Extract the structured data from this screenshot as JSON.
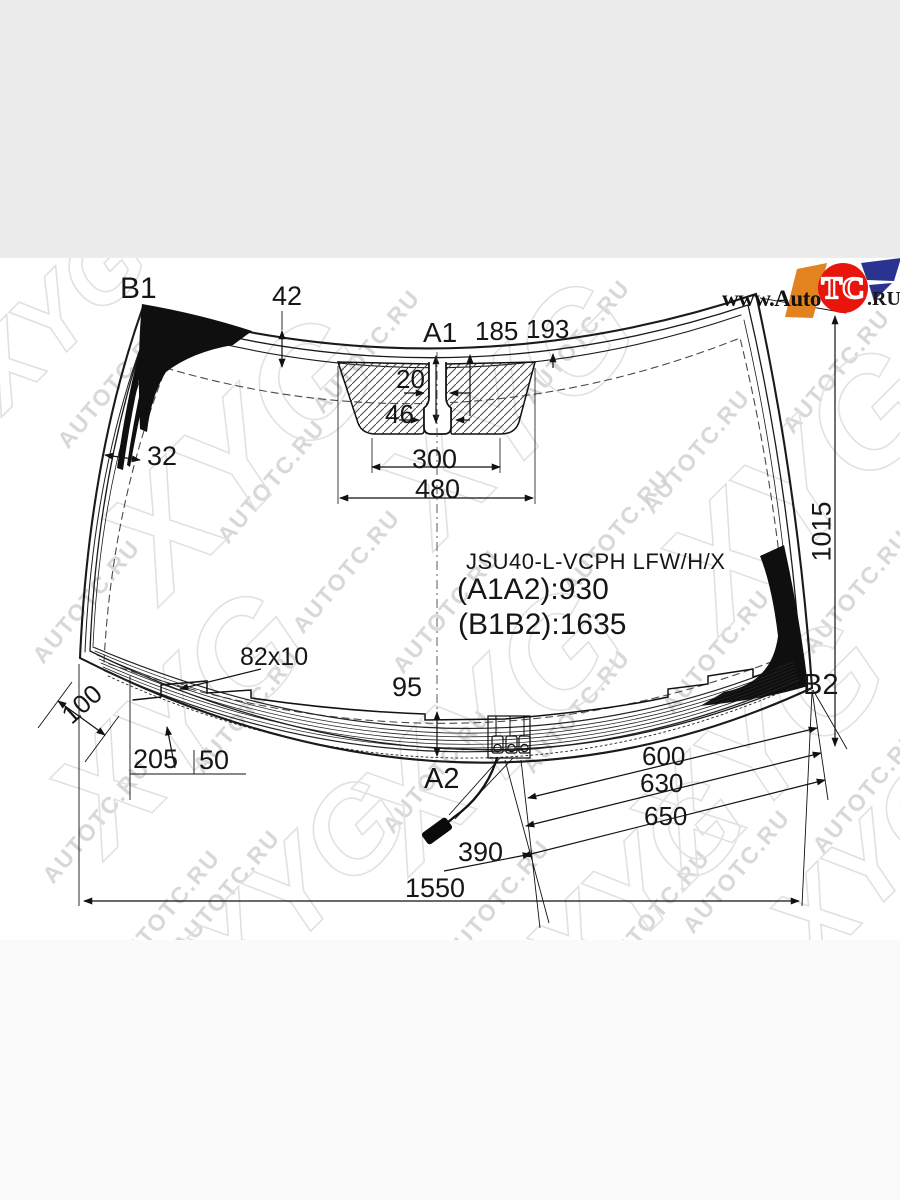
{
  "page": {
    "background_top": "#ececec",
    "background_canvas": "#ffffff",
    "background_bottom": "#fafafa",
    "line_color": "#161616"
  },
  "watermark": {
    "site_text": "AUTOTC.RU",
    "brand_text": "XYG"
  },
  "logo": {
    "prefix": "www.Auto",
    "badge": "TC",
    "suffix": ".RU",
    "red": "#e8150d",
    "orange": "#e2831f",
    "blue": "#2b3390"
  },
  "part": {
    "code": "JSU40-L-VCPH LFW/H/X",
    "height_between_a": "(A1A2):930",
    "diagonal_between_b": "(B1B2):1635"
  },
  "points": {
    "top_left": "B1",
    "top_center": "A1",
    "bottom_center": "A2",
    "bottom_right": "B2"
  },
  "dims": {
    "frit_band_top": "42",
    "offset_a": "185",
    "offset_b": "193",
    "mirror_slot_width": "20",
    "sensor_window_width": "46",
    "bracket_inner_width": "300",
    "bracket_outer_width": "480",
    "frit_band_left": "32",
    "glass_height": "1015",
    "corner_band": "100",
    "heater_notch": "82x10",
    "center_to_edge": "95",
    "heater_offset_a": "205",
    "heater_offset_b": "50",
    "connector_a": "600",
    "connector_b": "630",
    "connector_c": "650",
    "wire_length": "390",
    "bottom_width": "1550"
  }
}
